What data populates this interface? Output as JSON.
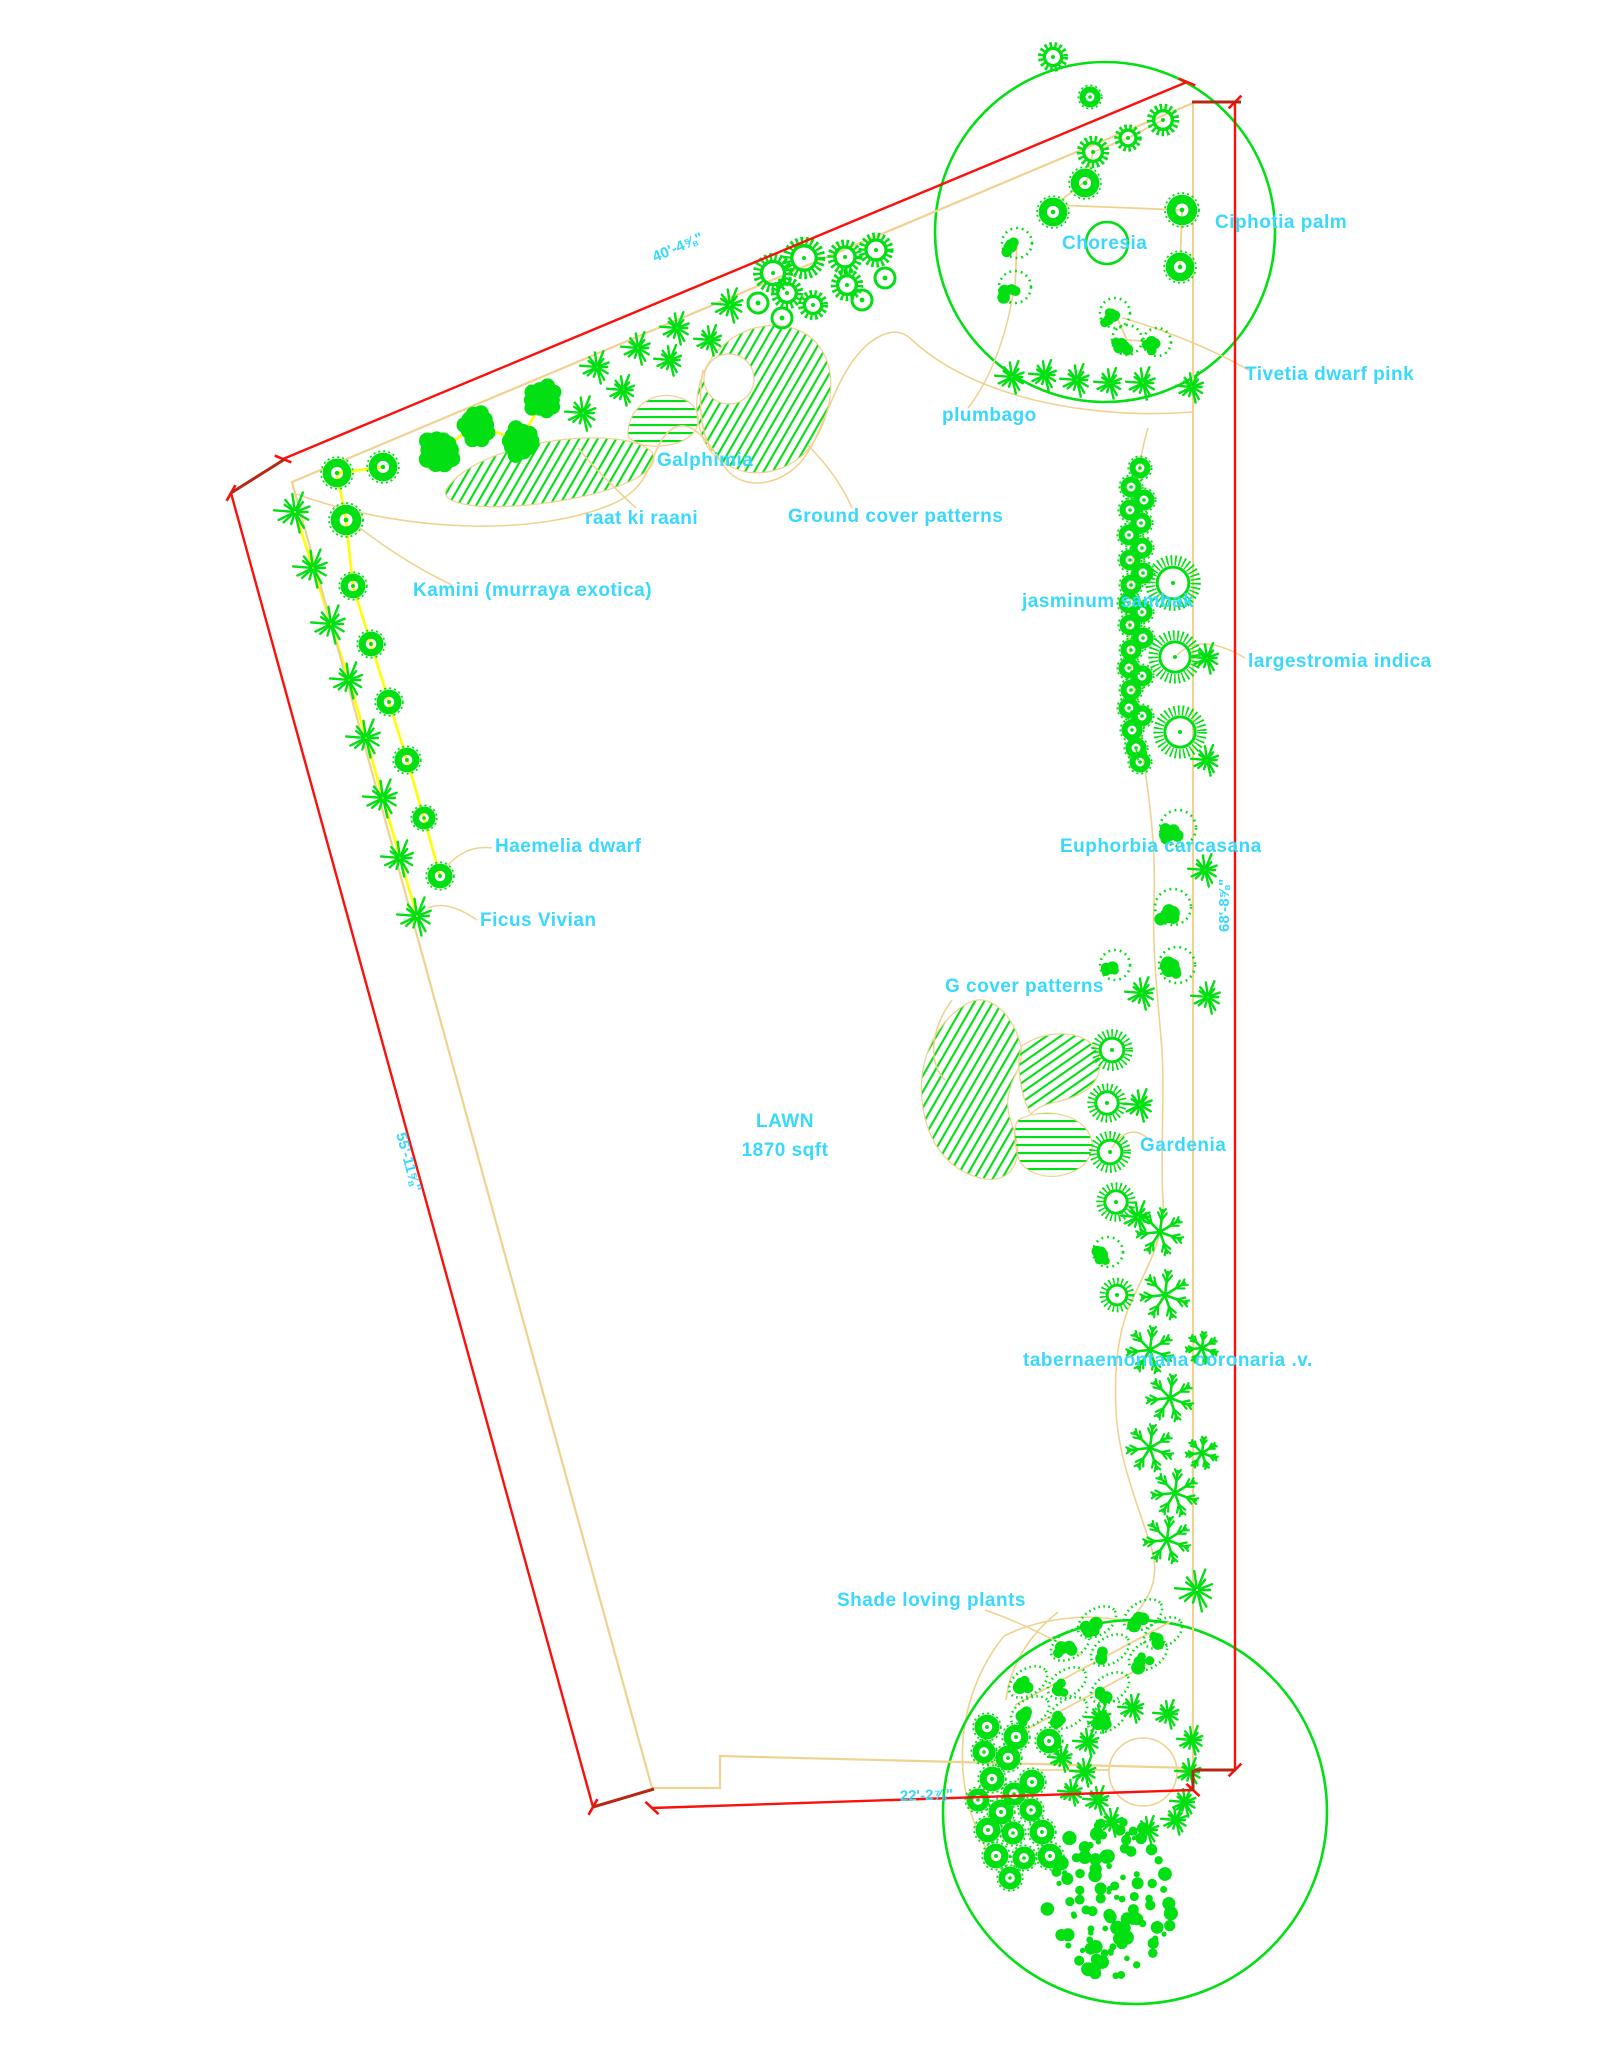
{
  "drawing_title": "Landscape planting plan",
  "colors": {
    "green": "#02df12",
    "cyan": "#38d8ff",
    "red": "#fb100c",
    "dark_red": "#b42814",
    "tan": "#efd28f",
    "yellow": "#ffff00",
    "bg": "#ffffff"
  },
  "lawn": {
    "line1": "LAWN",
    "line2": "1870 sqft",
    "x": 785,
    "y1": 1127,
    "y2": 1156
  },
  "labels": [
    {
      "text": "Ciphotia palm",
      "x": 1215,
      "y": 228
    },
    {
      "text": "Choresia",
      "x": 1062,
      "y": 249
    },
    {
      "text": "Tivetia dwarf pink",
      "x": 1245,
      "y": 380
    },
    {
      "text": "plumbago",
      "x": 942,
      "y": 421
    },
    {
      "text": "Galphimia",
      "x": 657,
      "y": 466
    },
    {
      "text": "raat ki raani",
      "x": 585,
      "y": 524
    },
    {
      "text": "Ground cover patterns",
      "x": 788,
      "y": 522
    },
    {
      "text": "Kamini (murraya exotica)",
      "x": 413,
      "y": 596
    },
    {
      "text": "jasminum sambak",
      "x": 1022,
      "y": 607
    },
    {
      "text": "largestromia indica",
      "x": 1248,
      "y": 667
    },
    {
      "text": "Haemelia dwarf",
      "x": 495,
      "y": 852
    },
    {
      "text": "Ficus Vivian",
      "x": 480,
      "y": 926
    },
    {
      "text": "Euphorbia carcasana",
      "x": 1060,
      "y": 852
    },
    {
      "text": "G cover patterns",
      "x": 945,
      "y": 992
    },
    {
      "text": "Gardenia",
      "x": 1140,
      "y": 1151
    },
    {
      "text": "tabernaemontana coronaria .v.",
      "x": 1023,
      "y": 1366
    },
    {
      "text": "Shade loving plants",
      "x": 837,
      "y": 1606
    }
  ],
  "dimensions": [
    {
      "label": "40'-4⅝\"",
      "x1": 283,
      "y1": 459,
      "x2": 1187,
      "y2": 82,
      "tx": 655,
      "ty": 262,
      "rot": -22.7
    },
    {
      "label": "55'-11⅝\"",
      "x1": 231,
      "y1": 493,
      "x2": 593,
      "y2": 1807,
      "tx": 396,
      "ty": 1134,
      "rot": 74.6
    },
    {
      "label": "68'-8⅝\"",
      "x1": 1235,
      "y1": 102,
      "x2": 1235,
      "y2": 1770,
      "tx": 1229,
      "ty": 932,
      "rot": -90
    },
    {
      "label": "22'-2⅞\"",
      "x1": 652,
      "y1": 1808,
      "x2": 1193,
      "y2": 1790,
      "tx": 900,
      "ty": 1801,
      "rot": -1.9
    }
  ],
  "corner_segments": [
    [
      285,
      459,
      231,
      493
    ],
    [
      1192,
      102,
      1241,
      102
    ],
    [
      593,
      1807,
      654,
      1789
    ],
    [
      1194,
      1770,
      1236,
      1770
    ],
    [
      1193,
      1770,
      1193,
      1791
    ]
  ],
  "plan": {
    "boundary": "M292,482 L1193,103 L1193,1768 L720,1756 L720,1788 L652,1788 Z",
    "green_circles": [
      {
        "cx": 1105,
        "cy": 232,
        "r": 170
      },
      {
        "cx": 1135,
        "cy": 1812,
        "r": 192
      }
    ],
    "bed_curves": [
      "M296,494 C420,538 545,532 610,505 C655,487 648,452 668,432 C688,414 706,438 724,466 C742,494 788,486 808,452 C826,424 836,372 868,344 C886,330 900,328 912,340 C975,398 1090,420 1193,412",
      "M1148,428 C1132,480 1136,540 1130,600 C1126,650 1136,700 1142,750 C1150,800 1156,850 1154,900 C1152,950 1158,1000 1162,1050 C1165,1100 1160,1150 1163,1200 C1165,1235 1150,1262 1132,1300 C1118,1330 1114,1370 1116,1410 C1118,1460 1140,1510 1152,1550 C1160,1578 1150,1600 1128,1622 C1090,1612 1040,1618 1004,1636",
      "M1004,1636 C952,1700 948,1796 996,1864",
      "M1058,1612 C1028,1636 1010,1666 1006,1700"
    ],
    "tan_lines": [
      [
        1163,
        120,
        1128,
        138,
        1093,
        152,
        1087,
        180,
        1055,
        205
      ],
      [
        1055,
        205,
        1182,
        210,
        1180,
        267
      ],
      [
        1017,
        243,
        1015,
        287
      ],
      [
        1115,
        313,
        1127,
        340,
        1157,
        342
      ],
      [
        1040,
        1770,
        1192,
        1770
      ],
      [
        1015,
        1705,
        1170,
        1622
      ],
      [
        1022,
        1732,
        1155,
        1660
      ]
    ],
    "tan_circles": [
      {
        "cx": 1143,
        "cy": 1772,
        "r": 34
      }
    ],
    "yellow_lines": [
      [
        383,
        467,
        337,
        473,
        346,
        520,
        353,
        586,
        371,
        644,
        389,
        702,
        407,
        760,
        424,
        818,
        440,
        876
      ],
      [
        295,
        512,
        313,
        568,
        331,
        624,
        349,
        680,
        366,
        738,
        383,
        798,
        400,
        858,
        417,
        916
      ],
      [
        440,
        450,
        477,
        425,
        520,
        441,
        543,
        400
      ]
    ],
    "leaders": [
      "M1252,372 C1215,350 1160,328 1122,318",
      "M968,408 C990,380 1005,340 1013,295",
      "M712,452 C700,430 698,400 703,370",
      "M636,508 C612,486 592,465 578,448",
      "M852,508 C840,480 822,460 808,445",
      "M452,585 C410,565 375,540 352,522",
      "M1245,658 C1215,640 1192,640 1177,655",
      "M492,848 C468,845 452,858 443,872",
      "M477,920 C455,905 440,903 428,908",
      "M952,1000 C930,1030 928,1062 945,1080",
      "M1152,1142 C1135,1125 1122,1132 1112,1148",
      "M985,1610 C1020,1622 1055,1640 1082,1655"
    ],
    "hatch_blobs": [
      {
        "d": "M448,487 C468,458 540,436 600,438 C648,440 664,454 648,470 C618,497 520,510 476,506 C452,503 440,498 448,487 Z",
        "pattern": "h1"
      },
      {
        "d": "M628,432 C629,409 650,392 673,396 C696,400 703,416 695,431 C684,446 655,449 640,444 C631,440 627,438 628,432 Z",
        "pattern": "h0"
      },
      {
        "d": "M701,433 C690,400 700,361 731,339 C762,318 801,322 819,346 C839,373 831,416 813,443 C796,469 761,479 736,469 C716,461 706,449 701,433 Z",
        "pattern": "h1"
      },
      {
        "d": "M968,1003 C935,1022 918,1060 922,1100 C926,1142 948,1170 980,1178 C1000,1183 1014,1174 1017,1157 C1021,1134 1005,1120 1008,1098 C1011,1075 1024,1068 1021,1048 C1018,1025 994,989 968,1003 Z",
        "pattern": "h1"
      },
      {
        "d": "M1022,1046 C1040,1033 1070,1029 1088,1041 C1106,1054 1103,1079 1085,1091 C1065,1104 1041,1101 1031,1114 C1021,1099 1015,1060 1022,1046 Z",
        "pattern": "h2"
      },
      {
        "d": "M1018,1120 C1040,1108 1074,1112 1087,1130 C1099,1148 1089,1167 1067,1174 C1044,1181 1022,1171 1018,1157 C1015,1144 1012,1130 1018,1120 Z",
        "pattern": "h0"
      }
    ],
    "white_holes": [
      {
        "cx": 729,
        "cy": 379,
        "r": 25
      }
    ]
  },
  "plants": [
    {
      "t": "gear",
      "x": 1053,
      "y": 57,
      "r": 12
    },
    {
      "t": "ring",
      "x": 1090,
      "y": 97,
      "r": 11
    },
    {
      "t": "gear",
      "x": 1163,
      "y": 120,
      "r": 13
    },
    {
      "t": "gear",
      "x": 1128,
      "y": 138,
      "r": 11
    },
    {
      "t": "gear",
      "x": 1093,
      "y": 152,
      "r": 13
    },
    {
      "t": "ring",
      "x": 1085,
      "y": 183,
      "r": 15
    },
    {
      "t": "ring",
      "x": 1053,
      "y": 212,
      "r": 15
    },
    {
      "t": "ring",
      "x": 1182,
      "y": 210,
      "r": 16
    },
    {
      "t": "ring",
      "x": 1180,
      "y": 267,
      "r": 15
    },
    {
      "t": "plain",
      "x": 1107,
      "y": 243,
      "r": 21
    },
    {
      "t": "dshrub",
      "x": 1017,
      "y": 243,
      "r": 15
    },
    {
      "t": "dshrub",
      "x": 1015,
      "y": 287,
      "r": 16
    },
    {
      "t": "dshrub",
      "x": 1115,
      "y": 313,
      "r": 15
    },
    {
      "t": "dshrub",
      "x": 1127,
      "y": 340,
      "r": 15
    },
    {
      "t": "dshrub",
      "x": 1157,
      "y": 342,
      "r": 14
    },
    {
      "t": "star",
      "x": 1012,
      "y": 377,
      "r": 17
    },
    {
      "t": "star",
      "x": 1045,
      "y": 375,
      "r": 16
    },
    {
      "t": "star",
      "x": 1077,
      "y": 380,
      "r": 17
    },
    {
      "t": "star",
      "x": 1110,
      "y": 383,
      "r": 16
    },
    {
      "t": "star",
      "x": 1143,
      "y": 383,
      "r": 17
    },
    {
      "t": "star",
      "x": 1192,
      "y": 387,
      "r": 16
    },
    {
      "t": "gear",
      "x": 773,
      "y": 273,
      "r": 16
    },
    {
      "t": "gear",
      "x": 804,
      "y": 258,
      "r": 17
    },
    {
      "t": "gear",
      "x": 845,
      "y": 257,
      "r": 14
    },
    {
      "t": "gear",
      "x": 787,
      "y": 293,
      "r": 13
    },
    {
      "t": "gear",
      "x": 813,
      "y": 305,
      "r": 12
    },
    {
      "t": "gear",
      "x": 847,
      "y": 285,
      "r": 13
    },
    {
      "t": "gear",
      "x": 876,
      "y": 250,
      "r": 14
    },
    {
      "t": "open",
      "x": 758,
      "y": 303,
      "r": 10
    },
    {
      "t": "open",
      "x": 782,
      "y": 318,
      "r": 10
    },
    {
      "t": "open",
      "x": 862,
      "y": 300,
      "r": 10
    },
    {
      "t": "open",
      "x": 885,
      "y": 278,
      "r": 10
    },
    {
      "t": "star",
      "x": 583,
      "y": 413,
      "r": 18
    },
    {
      "t": "star",
      "x": 597,
      "y": 367,
      "r": 17
    },
    {
      "t": "star",
      "x": 623,
      "y": 390,
      "r": 16
    },
    {
      "t": "star",
      "x": 638,
      "y": 348,
      "r": 17
    },
    {
      "t": "star",
      "x": 670,
      "y": 360,
      "r": 16
    },
    {
      "t": "star",
      "x": 677,
      "y": 328,
      "r": 17
    },
    {
      "t": "star",
      "x": 710,
      "y": 340,
      "r": 16
    },
    {
      "t": "star",
      "x": 730,
      "y": 305,
      "r": 18
    },
    {
      "t": "bushy",
      "x": 440,
      "y": 450,
      "r": 21
    },
    {
      "t": "bushy",
      "x": 477,
      "y": 425,
      "r": 20
    },
    {
      "t": "bushy",
      "x": 520,
      "y": 441,
      "r": 20
    },
    {
      "t": "bushy",
      "x": 543,
      "y": 400,
      "r": 19
    },
    {
      "t": "ring",
      "x": 337,
      "y": 473,
      "r": 15
    },
    {
      "t": "ring",
      "x": 383,
      "y": 467,
      "r": 15
    },
    {
      "t": "ring",
      "x": 346,
      "y": 520,
      "r": 16
    },
    {
      "t": "ring",
      "x": 353,
      "y": 586,
      "r": 13
    },
    {
      "t": "ring",
      "x": 371,
      "y": 644,
      "r": 13
    },
    {
      "t": "ring",
      "x": 389,
      "y": 702,
      "r": 13
    },
    {
      "t": "ring",
      "x": 407,
      "y": 760,
      "r": 13
    },
    {
      "t": "ring",
      "x": 424,
      "y": 818,
      "r": 12
    },
    {
      "t": "ring",
      "x": 440,
      "y": 876,
      "r": 13
    },
    {
      "t": "star",
      "x": 295,
      "y": 512,
      "r": 21
    },
    {
      "t": "star",
      "x": 313,
      "y": 568,
      "r": 20
    },
    {
      "t": "star",
      "x": 331,
      "y": 624,
      "r": 20
    },
    {
      "t": "star",
      "x": 349,
      "y": 680,
      "r": 19
    },
    {
      "t": "star",
      "x": 366,
      "y": 738,
      "r": 20
    },
    {
      "t": "star",
      "x": 383,
      "y": 798,
      "r": 20
    },
    {
      "t": "star",
      "x": 400,
      "y": 858,
      "r": 19
    },
    {
      "t": "star",
      "x": 417,
      "y": 916,
      "r": 20
    },
    {
      "t": "jring",
      "x": 1140,
      "y": 468,
      "r": 11
    },
    {
      "t": "jring",
      "x": 1131,
      "y": 487,
      "r": 11
    },
    {
      "t": "jring",
      "x": 1144,
      "y": 500,
      "r": 11
    },
    {
      "t": "jring",
      "x": 1130,
      "y": 510,
      "r": 11
    },
    {
      "t": "jring",
      "x": 1141,
      "y": 523,
      "r": 11
    },
    {
      "t": "jring",
      "x": 1129,
      "y": 535,
      "r": 11
    },
    {
      "t": "jring",
      "x": 1142,
      "y": 548,
      "r": 11
    },
    {
      "t": "jring",
      "x": 1130,
      "y": 560,
      "r": 11
    },
    {
      "t": "jring",
      "x": 1143,
      "y": 573,
      "r": 11
    },
    {
      "t": "jring",
      "x": 1131,
      "y": 585,
      "r": 11
    },
    {
      "t": "jring",
      "x": 1129,
      "y": 603,
      "r": 11
    },
    {
      "t": "jring",
      "x": 1142,
      "y": 612,
      "r": 11
    },
    {
      "t": "jring",
      "x": 1130,
      "y": 625,
      "r": 11
    },
    {
      "t": "jring",
      "x": 1143,
      "y": 638,
      "r": 11
    },
    {
      "t": "jring",
      "x": 1131,
      "y": 650,
      "r": 11
    },
    {
      "t": "jring",
      "x": 1129,
      "y": 668,
      "r": 11
    },
    {
      "t": "jring",
      "x": 1142,
      "y": 676,
      "r": 11
    },
    {
      "t": "jring",
      "x": 1131,
      "y": 690,
      "r": 11
    },
    {
      "t": "jring",
      "x": 1129,
      "y": 708,
      "r": 11
    },
    {
      "t": "jring",
      "x": 1142,
      "y": 716,
      "r": 11
    },
    {
      "t": "jring",
      "x": 1132,
      "y": 730,
      "r": 11
    },
    {
      "t": "jring",
      "x": 1136,
      "y": 748,
      "r": 11
    },
    {
      "t": "jring",
      "x": 1140,
      "y": 762,
      "r": 11
    },
    {
      "t": "urchin",
      "x": 1173,
      "y": 583,
      "r": 24
    },
    {
      "t": "urchin",
      "x": 1175,
      "y": 657,
      "r": 23
    },
    {
      "t": "urchin",
      "x": 1180,
      "y": 732,
      "r": 23
    },
    {
      "t": "star",
      "x": 1207,
      "y": 658,
      "r": 16
    },
    {
      "t": "star",
      "x": 1207,
      "y": 760,
      "r": 16
    },
    {
      "t": "star",
      "x": 1205,
      "y": 870,
      "r": 17
    },
    {
      "t": "star",
      "x": 1208,
      "y": 997,
      "r": 17
    },
    {
      "t": "star",
      "x": 1142,
      "y": 993,
      "r": 17
    },
    {
      "t": "star",
      "x": 1140,
      "y": 1105,
      "r": 17
    },
    {
      "t": "star",
      "x": 1138,
      "y": 1217,
      "r": 17
    },
    {
      "t": "dshrub",
      "x": 1178,
      "y": 828,
      "r": 18
    },
    {
      "t": "dshrub",
      "x": 1173,
      "y": 907,
      "r": 18
    },
    {
      "t": "dshrub",
      "x": 1177,
      "y": 965,
      "r": 18
    },
    {
      "t": "dshrub",
      "x": 1115,
      "y": 965,
      "r": 15
    },
    {
      "t": "dshrub",
      "x": 1108,
      "y": 1252,
      "r": 15
    },
    {
      "t": "urchin",
      "x": 1112,
      "y": 1050,
      "r": 18
    },
    {
      "t": "urchin",
      "x": 1107,
      "y": 1103,
      "r": 17
    },
    {
      "t": "urchin",
      "x": 1110,
      "y": 1152,
      "r": 18
    },
    {
      "t": "urchin",
      "x": 1116,
      "y": 1202,
      "r": 17
    },
    {
      "t": "urchin",
      "x": 1117,
      "y": 1295,
      "r": 15
    },
    {
      "t": "snow",
      "x": 1160,
      "y": 1232,
      "r": 22
    },
    {
      "t": "snow",
      "x": 1165,
      "y": 1295,
      "r": 23
    },
    {
      "t": "snow",
      "x": 1150,
      "y": 1350,
      "r": 22
    },
    {
      "t": "snow",
      "x": 1202,
      "y": 1348,
      "r": 15
    },
    {
      "t": "snow",
      "x": 1170,
      "y": 1398,
      "r": 22
    },
    {
      "t": "snow",
      "x": 1150,
      "y": 1448,
      "r": 22
    },
    {
      "t": "snow",
      "x": 1202,
      "y": 1453,
      "r": 15
    },
    {
      "t": "snow",
      "x": 1175,
      "y": 1493,
      "r": 22
    },
    {
      "t": "snow",
      "x": 1167,
      "y": 1540,
      "r": 22
    },
    {
      "t": "star",
      "x": 1197,
      "y": 1590,
      "r": 22
    },
    {
      "t": "doval",
      "x": 1097,
      "y": 1622
    },
    {
      "t": "doval",
      "x": 1143,
      "y": 1615
    },
    {
      "t": "doval",
      "x": 1163,
      "y": 1633
    },
    {
      "t": "doval",
      "x": 1070,
      "y": 1645
    },
    {
      "t": "doval",
      "x": 1110,
      "y": 1650
    },
    {
      "t": "doval",
      "x": 1148,
      "y": 1655
    },
    {
      "t": "doval",
      "x": 1028,
      "y": 1682
    },
    {
      "t": "doval",
      "x": 1067,
      "y": 1683
    },
    {
      "t": "doval",
      "x": 1110,
      "y": 1688
    },
    {
      "t": "doval",
      "x": 1030,
      "y": 1712
    },
    {
      "t": "doval",
      "x": 1068,
      "y": 1713
    },
    {
      "t": "doval",
      "x": 1107,
      "y": 1717
    },
    {
      "t": "jring",
      "x": 987,
      "y": 1727,
      "r": 13
    },
    {
      "t": "jring",
      "x": 1016,
      "y": 1737,
      "r": 13
    },
    {
      "t": "jring",
      "x": 1049,
      "y": 1741,
      "r": 13
    },
    {
      "t": "jring",
      "x": 984,
      "y": 1752,
      "r": 12
    },
    {
      "t": "jring",
      "x": 1008,
      "y": 1758,
      "r": 13
    },
    {
      "t": "jring",
      "x": 992,
      "y": 1779,
      "r": 13
    },
    {
      "t": "jring",
      "x": 1032,
      "y": 1782,
      "r": 13
    },
    {
      "t": "jring",
      "x": 1014,
      "y": 1794,
      "r": 12
    },
    {
      "t": "jring",
      "x": 978,
      "y": 1800,
      "r": 12
    },
    {
      "t": "jring",
      "x": 1001,
      "y": 1812,
      "r": 13
    },
    {
      "t": "jring",
      "x": 1031,
      "y": 1810,
      "r": 12
    },
    {
      "t": "jring",
      "x": 988,
      "y": 1830,
      "r": 13
    },
    {
      "t": "jring",
      "x": 1013,
      "y": 1833,
      "r": 12
    },
    {
      "t": "jring",
      "x": 1042,
      "y": 1832,
      "r": 13
    },
    {
      "t": "jring",
      "x": 996,
      "y": 1856,
      "r": 13
    },
    {
      "t": "jring",
      "x": 1024,
      "y": 1858,
      "r": 12
    },
    {
      "t": "jring",
      "x": 1050,
      "y": 1856,
      "r": 13
    },
    {
      "t": "jring",
      "x": 1010,
      "y": 1878,
      "r": 12
    },
    {
      "t": "star",
      "x": 1100,
      "y": 1718,
      "r": 15
    },
    {
      "t": "star",
      "x": 1133,
      "y": 1708,
      "r": 15
    },
    {
      "t": "star",
      "x": 1168,
      "y": 1714,
      "r": 15
    },
    {
      "t": "star",
      "x": 1192,
      "y": 1740,
      "r": 15
    },
    {
      "t": "star",
      "x": 1088,
      "y": 1742,
      "r": 15
    },
    {
      "t": "star",
      "x": 1190,
      "y": 1772,
      "r": 15
    },
    {
      "t": "star",
      "x": 1085,
      "y": 1772,
      "r": 15
    },
    {
      "t": "star",
      "x": 1098,
      "y": 1800,
      "r": 15
    },
    {
      "t": "star",
      "x": 1185,
      "y": 1802,
      "r": 15
    },
    {
      "t": "star",
      "x": 1112,
      "y": 1822,
      "r": 15
    },
    {
      "t": "star",
      "x": 1148,
      "y": 1830,
      "r": 15
    },
    {
      "t": "star",
      "x": 1176,
      "y": 1820,
      "r": 15
    },
    {
      "t": "star",
      "x": 1062,
      "y": 1758,
      "r": 14
    },
    {
      "t": "star",
      "x": 1072,
      "y": 1792,
      "r": 14
    },
    {
      "t": "mass",
      "x": 1112,
      "y": 1898,
      "rx": 66,
      "ry": 80
    }
  ]
}
